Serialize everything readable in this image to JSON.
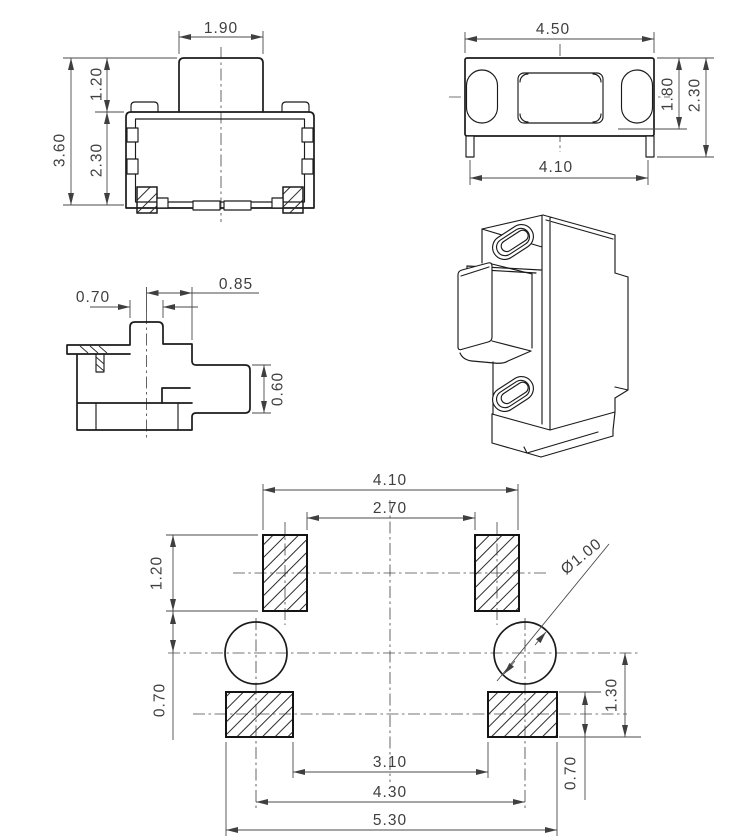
{
  "front": {
    "button_width": "1.90",
    "button_height": "1.20",
    "total_height": "3.60",
    "body_height": "2.30"
  },
  "top": {
    "body_width": "4.50",
    "lead_span": "4.10",
    "inner_depth": "1.80",
    "total_depth": "2.30"
  },
  "side": {
    "boss_width": "0.70",
    "center_to_face": "0.85",
    "stem_height": "0.60"
  },
  "pcb": {
    "top_span_outer": "4.10",
    "top_span_inner": "2.70",
    "top_pad_height": "1.20",
    "top_gap": "0.70",
    "hole_diameter": "Ø1.00",
    "center_drop": "1.30",
    "bottom_pad_height": "0.70",
    "bottom_span_inner": "3.10",
    "hole_span": "4.30",
    "bottom_span_outer": "5.30"
  }
}
